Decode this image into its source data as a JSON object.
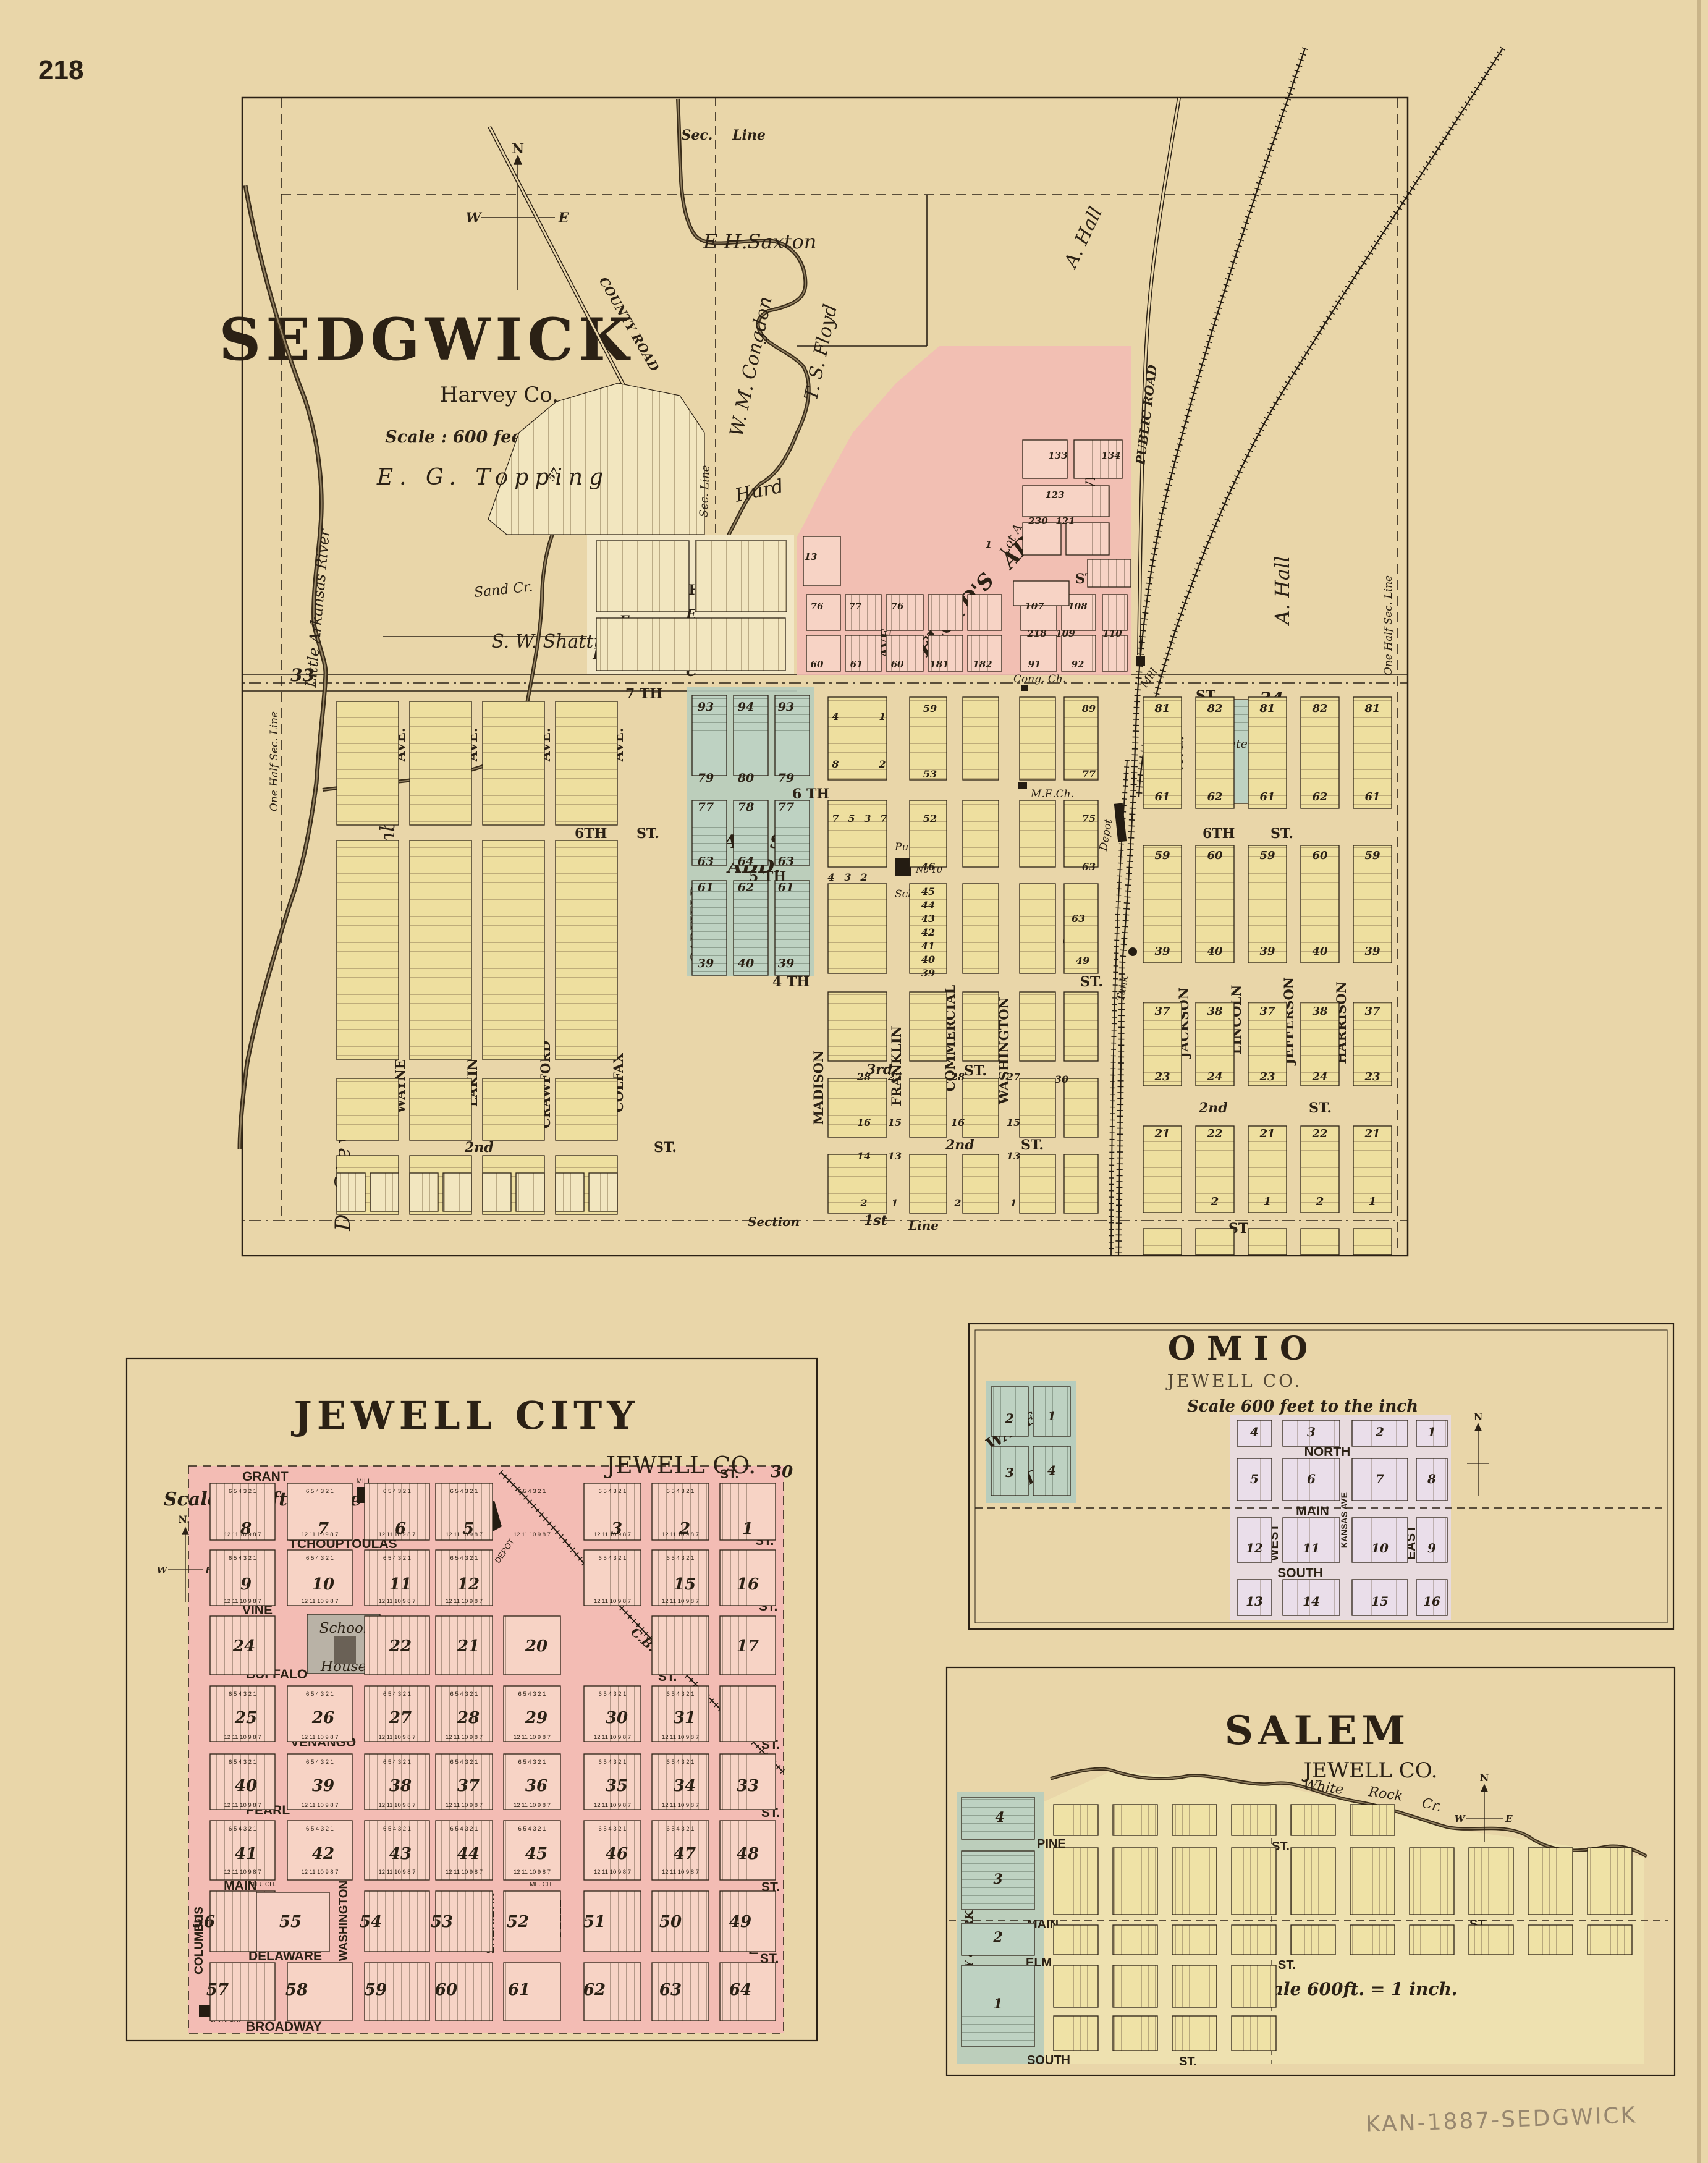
{
  "page": {
    "number": "218",
    "annotation": "KAN-1887-SEDGWICK"
  },
  "sedgwick": {
    "title": "SEDGWICK",
    "county": "Harvey Co.",
    "scale": "Scale : 600 feet =1 inch.",
    "compass": {
      "n": "N",
      "w": "W",
      "e": "E"
    },
    "owners": {
      "saxton": "E H.Saxton",
      "topping": "E. G. Topping",
      "congdon": "W. M. Congdon",
      "floyd": "T. S. Floyd",
      "hall_ne": "A. Hall",
      "hall_e": "A. Hall",
      "hurd": "Hurd",
      "shattuck": "S. W. Shattuck",
      "chamberlin": "I. Chamberlin",
      "stevens": "D. Stevens"
    },
    "roads": {
      "county": "COUNTY ROAD",
      "public": "PUBLIC ROAD"
    },
    "lines": {
      "sec": "Sec.",
      "line": "Line",
      "sec_line": "Sec. Line",
      "half_w": "One Half Sec. Line",
      "half_e": "One Half Sec. Line",
      "section": "Section",
      "line_b": "Line",
      "s33": "33",
      "s34": "34"
    },
    "rivers": {
      "river": "Little Arkansas River",
      "sand": "Sand Cr."
    },
    "additions": {
      "halls1": "HALL'S",
      "halls2": "ADD.",
      "hurds": "HURD'S ADD.",
      "floyds1": "FLOYD'S",
      "floyds2": "ADD.",
      "lot_a": "Lot A"
    },
    "streets": {
      "s8": "8 TH",
      "s7": "7 TH",
      "s6": "6 TH",
      "s6b": "6TH",
      "s5": "5 TH",
      "s4": "4 TH",
      "s3": "3rd",
      "s2": "2nd",
      "s1": "1st",
      "st": "ST."
    },
    "avenues": {
      "wayne": "WAYNE",
      "lakin": "LAKIN",
      "crawford": "CRAWFORD",
      "colfax": "COLFAX",
      "madison": "MADISON",
      "franklin": "FRANKLIN",
      "commercial": "COMMERCIAL",
      "washington": "WASHINGTON",
      "jackson": "JACKSON",
      "lincoln": "LINCOLN",
      "jefferson": "JEFFERSON",
      "harrison": "HARRISON",
      "garfield": "GARFIELD",
      "ave": "AVE."
    },
    "pois": {
      "cemetery": "Cemetery",
      "cong": "Cong. Ch.",
      "me": "M.E.Ch.",
      "pub1": "Public",
      "pub2": "School",
      "pub3": "No 10",
      "depot": "Depot",
      "elevators": "Elevators",
      "tank": "Tank",
      "mill": "Mill"
    },
    "hurd_blocks": {
      "f": "F",
      "e": "E",
      "c": "C"
    },
    "nums": {
      "halls": [
        "93",
        "94",
        "93",
        "79",
        "80",
        "79",
        "77",
        "78",
        "77",
        "63",
        "64",
        "63",
        "61",
        "62",
        "61",
        "39",
        "40",
        "39"
      ],
      "east": [
        [
          "81",
          "82",
          "81",
          "82",
          "81"
        ],
        [
          "61",
          "62",
          "61",
          "62",
          "61"
        ],
        [
          "59",
          "60",
          "59",
          "60",
          "59"
        ],
        [
          "39",
          "40",
          "39",
          "40",
          "39"
        ],
        [
          "37",
          "38",
          "37",
          "38",
          "37"
        ],
        [
          "23",
          "24",
          "23",
          "24",
          "23"
        ],
        [
          "21",
          "22",
          "21",
          "22",
          "21"
        ],
        [
          "",
          "2",
          "1",
          "2",
          "1"
        ]
      ],
      "central": [
        "4",
        "1",
        "8",
        "2",
        "59",
        "89",
        "53",
        "77",
        "7",
        "5",
        "3",
        "7",
        "52",
        "75",
        "4",
        "3",
        "2",
        "46",
        "63",
        "45",
        "44",
        "43",
        "42",
        "41",
        "40",
        "39",
        "63",
        "49",
        "28",
        "27",
        "28",
        "27",
        "30",
        "16",
        "15",
        "16",
        "15",
        "14",
        "13",
        "13",
        "2",
        "1",
        "2",
        "1"
      ],
      "floyd": [
        "133",
        "134",
        "123",
        "230",
        "121",
        "1",
        "13",
        "218",
        "109",
        "110",
        "76",
        "77",
        "76",
        "107",
        "108",
        "60",
        "61",
        "60",
        "181",
        "182",
        "91",
        "92",
        "57"
      ]
    }
  },
  "jewell": {
    "title": "JEWELL CITY",
    "county": "JEWELL CO.",
    "scale": "Scale 600 ft. to the inch.",
    "corner": "30",
    "compass": {
      "n": "N.",
      "w": "W",
      "e": "E"
    },
    "streets": {
      "grant": "GRANT",
      "tchoup": "TCHOUPTOULAS",
      "vine": "VINE",
      "buffalo": "BUFFALO",
      "venango": "VENANGO",
      "pearl": "PEARL",
      "main": "MAIN",
      "delaware": "DELAWARE",
      "broadway": "BROADWAY",
      "st": "ST."
    },
    "avenues": {
      "columbus": "COLUMBUS",
      "custer": "CUSTER",
      "washington": "WASHINGTON",
      "lincoln": "LINCOLN",
      "sheridan": "SHERIDAN",
      "belle": "BELLE",
      "smith": "SMITH",
      "will": "WILL",
      "mechanic": "MECHANIC"
    },
    "railroad": {
      "a": "C.B.U.P.",
      "b": "R.R."
    },
    "pois": {
      "mill": "MILL",
      "depot": "DEPOT",
      "school1": "School",
      "school2": "House",
      "bap": "BAP. CH.",
      "evang": "EVANG. CH.",
      "chr": "CHR. CH.",
      "me": "ME. CH.",
      "cath": "CATH. CH."
    },
    "lot_top": "6 5 4 3 2 1",
    "lot_bottom": "12 11 10 9 8 7",
    "rows": [
      [
        "8",
        "7",
        "6",
        "5",
        "3",
        "2",
        "1"
      ],
      [
        "9",
        "10",
        "11",
        "12",
        "15",
        "16"
      ],
      [
        "24",
        "22",
        "21",
        "20",
        "17"
      ],
      [
        "25",
        "26",
        "27",
        "28",
        "29",
        "30",
        "31"
      ],
      [
        "40",
        "39",
        "38",
        "37",
        "36",
        "35",
        "34",
        "33"
      ],
      [
        "41",
        "42",
        "43",
        "44",
        "45",
        "46",
        "47",
        "48"
      ],
      [
        "56",
        "55",
        "54",
        "53",
        "52",
        "51",
        "50",
        "49"
      ],
      [
        "57",
        "58",
        "59",
        "60",
        "61",
        "62",
        "63",
        "64"
      ]
    ]
  },
  "omio": {
    "title": "OMIO",
    "county": "JEWELL CO.",
    "scale": "Scale 600 feet to the inch",
    "wades": {
      "a": "WADE'S",
      "b": "ADD."
    },
    "streets": {
      "north": "NORTH",
      "main": "MAIN",
      "south": "SOUTH"
    },
    "avenues": {
      "west": "WEST",
      "kansas": "KANSAS AVE",
      "east": "EAST"
    },
    "compass": {
      "n": "N"
    },
    "wade_nums": [
      "2",
      "1",
      "3",
      "4"
    ],
    "rows": [
      [
        "4",
        "3",
        "2",
        "1"
      ],
      [
        "5",
        "6",
        "7",
        "8"
      ],
      [
        "12",
        "11",
        "10",
        "9"
      ],
      [
        "13",
        "14",
        "15",
        "16"
      ]
    ]
  },
  "salem": {
    "title": "SALEM",
    "county": "JEWELL CO.",
    "creek": {
      "a": "White",
      "b": "Rock",
      "c": "Cr."
    },
    "addition": "DUDLEY & PARKER'S ADD",
    "add_nums": [
      "4",
      "3",
      "2",
      "1"
    ],
    "streets": {
      "pine": "PINE",
      "main": "MAIN",
      "elm": "ELM",
      "south": "SOUTH",
      "st": "ST."
    },
    "scale": "Scale 600ft. = 1 inch.",
    "compass": {
      "n": "N",
      "w": "W",
      "e": "E"
    }
  }
}
